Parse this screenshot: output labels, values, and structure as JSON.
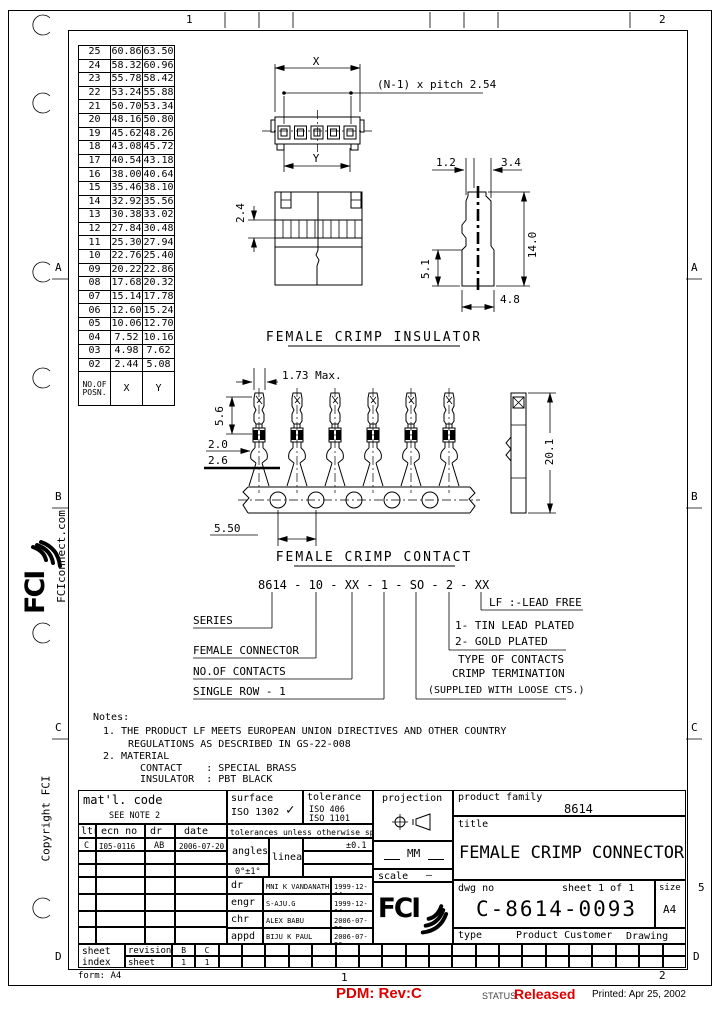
{
  "colors": {
    "ink": "#000000",
    "paper": "#ffffff",
    "alert_red": "#dd0000",
    "muted": "#444444"
  },
  "zones": {
    "top": [
      "1",
      "2"
    ],
    "bottom": [
      "1",
      "2"
    ],
    "left": [
      "A",
      "B",
      "C",
      "D"
    ],
    "right": [
      "A",
      "B",
      "C",
      "5",
      "D"
    ]
  },
  "margin": {
    "website": "FCIconnect.com",
    "brand": "FCI",
    "copyright": "Copyright  FCI"
  },
  "positions_table": {
    "header_posn": "NO.OF POSN.",
    "header_x": "X",
    "header_y": "Y",
    "rows": [
      [
        "25",
        "60.86",
        "63.50"
      ],
      [
        "24",
        "58.32",
        "60.96"
      ],
      [
        "23",
        "55.78",
        "58.42"
      ],
      [
        "22",
        "53.24",
        "55.88"
      ],
      [
        "21",
        "50.70",
        "53.34"
      ],
      [
        "20",
        "48.16",
        "50.80"
      ],
      [
        "19",
        "45.62",
        "48.26"
      ],
      [
        "18",
        "43.08",
        "45.72"
      ],
      [
        "17",
        "40.54",
        "43.18"
      ],
      [
        "16",
        "38.00",
        "40.64"
      ],
      [
        "15",
        "35.46",
        "38.10"
      ],
      [
        "14",
        "32.92",
        "35.56"
      ],
      [
        "13",
        "30.38",
        "33.02"
      ],
      [
        "12",
        "27.84",
        "30.48"
      ],
      [
        "11",
        "25.30",
        "27.94"
      ],
      [
        "10",
        "22.76",
        "25.40"
      ],
      [
        "09",
        "20.22",
        "22.86"
      ],
      [
        "08",
        "17.68",
        "20.32"
      ],
      [
        "07",
        "15.14",
        "17.78"
      ],
      [
        "06",
        "12.60",
        "15.24"
      ],
      [
        "05",
        "10.06",
        "12.70"
      ],
      [
        "04",
        "7.52",
        "10.16"
      ],
      [
        "03",
        "4.98",
        "7.62"
      ],
      [
        "02",
        "2.44",
        "5.08"
      ]
    ]
  },
  "insulator": {
    "heading": "FEMALE CRIMP INSULATOR",
    "dim_x": "X",
    "dim_y": "Y",
    "pitch_note": "(N-1) x pitch  2.54",
    "dim_2_4": "2.4",
    "dim_1_2": "1.2",
    "dim_3_4": "3.4",
    "dim_14_0": "14.0",
    "dim_5_1": "5.1",
    "dim_4_8": "4.8"
  },
  "contact": {
    "heading": "FEMALE CRIMP CONTACT",
    "dim_1_73": "1.73  Max.",
    "dim_5_6": "5.6",
    "dim_2_0": "2.0",
    "dim_2_6": "2.6",
    "dim_5_50": "5.50",
    "dim_20_1": "20.1"
  },
  "part_number": {
    "code": "8614 - 10 - XX - 1 - SO - 2 - XX",
    "series": "SERIES",
    "female_connector": "FEMALE CONNECTOR",
    "no_of_contacts": "NO.OF CONTACTS",
    "single_row": "SINGLE ROW  - 1",
    "lead_free": "LF :-LEAD FREE",
    "tin": "1-  TIN LEAD PLATED",
    "gold": "2-  GOLD PLATED",
    "type_of_contacts": "TYPE OF CONTACTS",
    "crimp_termination": "CRIMP TERMINATION",
    "supplied": "(SUPPLIED WITH LOOSE CTS.)"
  },
  "notes": {
    "label": "Notes:",
    "n1a": "1. THE PRODUCT LF MEETS EUROPEAN UNION DIRECTIVES AND OTHER COUNTRY",
    "n1b": "REGULATIONS AS DESCRIBED IN GS-22-008",
    "n2": "2. MATERIAL",
    "n2a": "CONTACT    : SPECIAL BRASS",
    "n2b": "INSULATOR  : PBT BLACK"
  },
  "title_block": {
    "matl_label": "mat'l. code",
    "matl_note": "SEE NOTE 2",
    "surface_label": "surface",
    "surface_value": "ISO  1302",
    "surface_check_icon": "✓",
    "tolerance_label": "tolerance",
    "tolerance_iso1": "ISO 406",
    "tolerance_iso2": "ISO 1101",
    "projection_label": "projection",
    "product_family_label": "product family",
    "product_family_value": "8614",
    "title_label": "title",
    "title_value": "FEMALE CRIMP CONNECTOR",
    "rev_headers": [
      "ltr",
      "ecn  no",
      "dr",
      "date"
    ],
    "rev_entry": {
      "ltr": "C",
      "ecn": "I05-0116",
      "dr": "AB",
      "date": "2006-07-20"
    },
    "tol_note": "tolerances unless otherwise specified",
    "angles_label": "angles",
    "angles_tol": "0°±1°",
    "linear_label": "linear",
    "linear_tol": "±0.1",
    "units": "MM",
    "scale_label": "scale",
    "scale_value": "—",
    "signatures": [
      {
        "role": "dr",
        "name": "MNI K VANDANATH",
        "date": "1999-12-14"
      },
      {
        "role": "engr",
        "name": "S-AJU.G",
        "date": "1999-12-14"
      },
      {
        "role": "chr",
        "name": "ALEX BABU",
        "date": "2006-07-20"
      },
      {
        "role": "appd",
        "name": "BIJU K PAUL",
        "date": "2006-07-20"
      }
    ],
    "dwg_no_label": "dwg  no",
    "dwg_no": "C-8614-0093",
    "sheet_info": "sheet 1  of  1",
    "size_label": "size",
    "size_value": "A4",
    "type_label": "type",
    "type_value": "Product  Customer",
    "type_value2": "Drawing",
    "sheet_index_l1": "sheet",
    "sheet_index_l2": "index",
    "revision_label": "revision",
    "sheet_label": "sheet",
    "revision_cells": [
      "B",
      "C"
    ],
    "sheet_cells": [
      "1",
      "1"
    ],
    "brand": "FCI"
  },
  "footer": {
    "form": "form: A4",
    "pdm": "PDM: Rev:C",
    "status_label": "STATUS:",
    "status_value": "Released",
    "printed": "Printed: Apr  25, 2002"
  }
}
